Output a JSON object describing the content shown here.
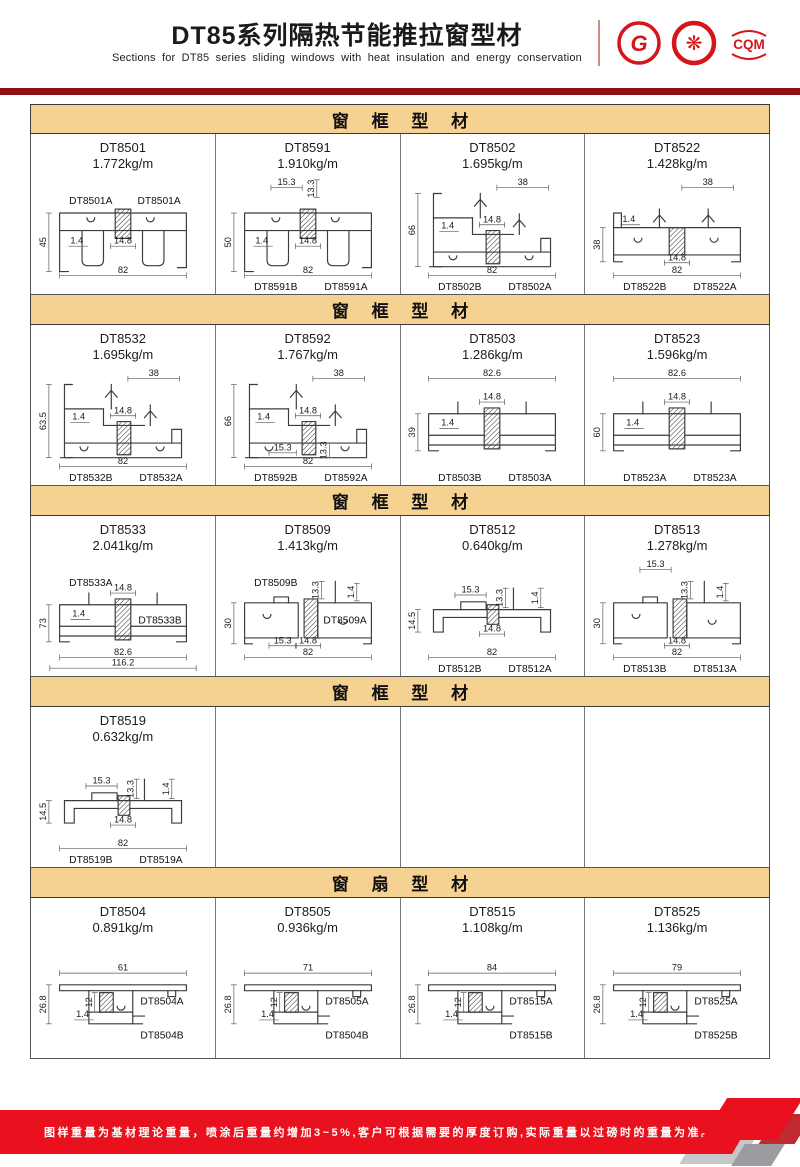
{
  "header": {
    "title": "DT85系列隔热节能推拉窗型材",
    "subtitle": "Sections for DT85 series sliding windows with heat insulation and energy conservation",
    "logos": [
      {
        "name": "jiahua-certification-logo",
        "label": "G"
      },
      {
        "name": "round-emblem-logo",
        "label": "❋"
      },
      {
        "name": "cqm-certification-logo",
        "label": "CQM"
      }
    ]
  },
  "colors": {
    "section_header_tan": "#f6d292",
    "header_rule_dark_red": "#8e1114",
    "footer_red": "#e8111d",
    "logo_red": "#d61518"
  },
  "sections": [
    {
      "title": "窗 框 型 材",
      "cells": [
        {
          "model": "DT8501",
          "weight": "1.772kg/m",
          "figure": "dc",
          "part_labels": [
            {
              "text": "DT8501A",
              "pos": "top-left"
            },
            {
              "text": "DT8501A",
              "pos": "top-right"
            }
          ],
          "dims": [
            {
              "v": "45",
              "pos": "left"
            },
            {
              "v": "1.4",
              "pos": "wall"
            },
            {
              "v": "14.8",
              "pos": "interlock"
            },
            {
              "v": "82",
              "pos": "bottom"
            }
          ]
        },
        {
          "model": "DT8591",
          "weight": "1.910kg/m",
          "figure": "dc",
          "part_labels": [
            {
              "text": "DT8591B",
              "pos": "bottom-left"
            },
            {
              "text": "DT8591A",
              "pos": "bottom-right"
            }
          ],
          "dims": [
            {
              "v": "15.3",
              "pos": "top-sm1"
            },
            {
              "v": "13.3",
              "pos": "top-sm2"
            },
            {
              "v": "50",
              "pos": "left"
            },
            {
              "v": "1.4",
              "pos": "wall"
            },
            {
              "v": "14.8",
              "pos": "interlock"
            },
            {
              "v": "82",
              "pos": "bottom"
            }
          ]
        },
        {
          "model": "DT8502",
          "weight": "1.695kg/m",
          "figure": "step",
          "part_labels": [
            {
              "text": "DT8502B",
              "pos": "bottom-left"
            },
            {
              "text": "DT8502A",
              "pos": "bottom-right"
            }
          ],
          "dims": [
            {
              "v": "38",
              "pos": "top"
            },
            {
              "v": "66",
              "pos": "left"
            },
            {
              "v": "1.4",
              "pos": "wall"
            },
            {
              "v": "14.8",
              "pos": "interlock"
            },
            {
              "v": "82",
              "pos": "bottom"
            }
          ]
        },
        {
          "model": "DT8522",
          "weight": "1.428kg/m",
          "figure": "hook",
          "part_labels": [
            {
              "text": "DT8522B",
              "pos": "bottom-left"
            },
            {
              "text": "DT8522A",
              "pos": "bottom-right"
            }
          ],
          "dims": [
            {
              "v": "38",
              "pos": "top"
            },
            {
              "v": "1.4",
              "pos": "wall"
            },
            {
              "v": "38",
              "pos": "left"
            },
            {
              "v": "14.8",
              "pos": "interlock"
            },
            {
              "v": "82",
              "pos": "bottom"
            }
          ]
        }
      ]
    },
    {
      "title": "窗 框 型 材",
      "cells": [
        {
          "model": "DT8532",
          "weight": "1.695kg/m",
          "figure": "step",
          "part_labels": [
            {
              "text": "DT8532B",
              "pos": "bottom-left"
            },
            {
              "text": "DT8532A",
              "pos": "bottom-right"
            }
          ],
          "dims": [
            {
              "v": "38",
              "pos": "top"
            },
            {
              "v": "63.5",
              "pos": "left"
            },
            {
              "v": "1.4",
              "pos": "wall"
            },
            {
              "v": "14.8",
              "pos": "interlock"
            },
            {
              "v": "82",
              "pos": "bottom"
            }
          ]
        },
        {
          "model": "DT8592",
          "weight": "1.767kg/m",
          "figure": "step",
          "part_labels": [
            {
              "text": "DT8592B",
              "pos": "bottom-left"
            },
            {
              "text": "DT8592A",
              "pos": "bottom-right"
            }
          ],
          "dims": [
            {
              "v": "38",
              "pos": "top"
            },
            {
              "v": "66",
              "pos": "left"
            },
            {
              "v": "1.4",
              "pos": "wall"
            },
            {
              "v": "14.8",
              "pos": "interlock"
            },
            {
              "v": "15.3",
              "pos": "bottom-sm"
            },
            {
              "v": "13.3",
              "pos": "bottom-sm2"
            },
            {
              "v": "82",
              "pos": "bottom"
            }
          ]
        },
        {
          "model": "DT8503",
          "weight": "1.286kg/m",
          "figure": "flat",
          "part_labels": [
            {
              "text": "DT8503B",
              "pos": "bottom-left"
            },
            {
              "text": "DT8503A",
              "pos": "bottom-right"
            }
          ],
          "dims": [
            {
              "v": "82.6",
              "pos": "top"
            },
            {
              "v": "1.4",
              "pos": "wall"
            },
            {
              "v": "14.8",
              "pos": "interlock"
            },
            {
              "v": "39",
              "pos": "left"
            }
          ]
        },
        {
          "model": "DT8523",
          "weight": "1.596kg/m",
          "figure": "flat",
          "part_labels": [
            {
              "text": "DT8523A",
              "pos": "bottom-left"
            },
            {
              "text": "DT8523A",
              "pos": "bottom-right"
            }
          ],
          "dims": [
            {
              "v": "82.6",
              "pos": "top"
            },
            {
              "v": "1.4",
              "pos": "wall"
            },
            {
              "v": "60",
              "pos": "left"
            },
            {
              "v": "14.8",
              "pos": "interlock"
            }
          ]
        }
      ]
    },
    {
      "title": "窗 框 型 材",
      "cells": [
        {
          "model": "DT8533",
          "weight": "2.041kg/m",
          "figure": "flat",
          "part_labels": [
            {
              "text": "DT8533A",
              "pos": "top-left"
            },
            {
              "text": "DT8533B",
              "pos": "mid-right"
            }
          ],
          "dims": [
            {
              "v": "73",
              "pos": "left"
            },
            {
              "v": "1.4",
              "pos": "wall"
            },
            {
              "v": "14.8",
              "pos": "interlock"
            },
            {
              "v": "82.6",
              "pos": "bottom"
            },
            {
              "v": "116.2",
              "pos": "bottom2"
            }
          ]
        },
        {
          "model": "DT8509",
          "weight": "1.413kg/m",
          "figure": "mid",
          "part_labels": [
            {
              "text": "DT8509B",
              "pos": "top-left"
            },
            {
              "text": "DT8509A",
              "pos": "mid-right"
            }
          ],
          "dims": [
            {
              "v": "13.3",
              "pos": "top-sm2"
            },
            {
              "v": "1.4",
              "pos": "right-sm"
            },
            {
              "v": "30",
              "pos": "left"
            },
            {
              "v": "15.3",
              "pos": "bottom-sm"
            },
            {
              "v": "14.8",
              "pos": "interlock"
            },
            {
              "v": "82",
              "pos": "bottom"
            }
          ]
        },
        {
          "model": "DT8512",
          "weight": "0.640kg/m",
          "figure": "thin",
          "part_labels": [
            {
              "text": "DT8512B",
              "pos": "bottom-left"
            },
            {
              "text": "DT8512A",
              "pos": "bottom-right"
            }
          ],
          "dims": [
            {
              "v": "15.3",
              "pos": "top-sm1"
            },
            {
              "v": "13.3",
              "pos": "top-sm2"
            },
            {
              "v": "1.4",
              "pos": "right-sm"
            },
            {
              "v": "14.5",
              "pos": "left"
            },
            {
              "v": "14.8",
              "pos": "interlock"
            },
            {
              "v": "82",
              "pos": "bottom"
            }
          ]
        },
        {
          "model": "DT8513",
          "weight": "1.278kg/m",
          "figure": "mid",
          "part_labels": [
            {
              "text": "DT8513B",
              "pos": "bottom-left"
            },
            {
              "text": "DT8513A",
              "pos": "bottom-right"
            }
          ],
          "dims": [
            {
              "v": "15.3",
              "pos": "top-sm1"
            },
            {
              "v": "13.3",
              "pos": "top-sm2"
            },
            {
              "v": "1.4",
              "pos": "right-sm"
            },
            {
              "v": "30",
              "pos": "left"
            },
            {
              "v": "14.8",
              "pos": "interlock"
            },
            {
              "v": "82",
              "pos": "bottom"
            }
          ]
        }
      ]
    },
    {
      "title": "窗 框 型 材",
      "cells": [
        {
          "model": "DT8519",
          "weight": "0.632kg/m",
          "figure": "thin",
          "part_labels": [
            {
              "text": "DT8519B",
              "pos": "bottom-left"
            },
            {
              "text": "DT8519A",
              "pos": "bottom-right"
            }
          ],
          "dims": [
            {
              "v": "15.3",
              "pos": "top-sm1"
            },
            {
              "v": "13.3",
              "pos": "top-sm2"
            },
            {
              "v": "1.4",
              "pos": "right-sm"
            },
            {
              "v": "14.5",
              "pos": "left"
            },
            {
              "v": "14.8",
              "pos": "interlock"
            },
            {
              "v": "82",
              "pos": "bottom"
            }
          ]
        },
        null,
        null,
        null
      ]
    },
    {
      "title": "窗 扇 型 材",
      "cells": [
        {
          "model": "DT8504",
          "weight": "0.891kg/m",
          "figure": "sash",
          "part_labels": [
            {
              "text": "DT8504A",
              "pos": "right-mid"
            },
            {
              "text": "DT8504B",
              "pos": "right-low"
            }
          ],
          "dims": [
            {
              "v": "61",
              "pos": "top"
            },
            {
              "v": "26.8",
              "pos": "left"
            },
            {
              "v": "12",
              "pos": "inner-v"
            },
            {
              "v": "1.4",
              "pos": "wall"
            }
          ]
        },
        {
          "model": "DT8505",
          "weight": "0.936kg/m",
          "figure": "sash",
          "part_labels": [
            {
              "text": "DT8505A",
              "pos": "right-mid"
            },
            {
              "text": "DT8504B",
              "pos": "right-low"
            }
          ],
          "dims": [
            {
              "v": "71",
              "pos": "top"
            },
            {
              "v": "26.8",
              "pos": "left"
            },
            {
              "v": "12",
              "pos": "inner-v"
            },
            {
              "v": "1.4",
              "pos": "wall"
            }
          ]
        },
        {
          "model": "DT8515",
          "weight": "1.108kg/m",
          "figure": "sash",
          "part_labels": [
            {
              "text": "DT8515A",
              "pos": "right-mid"
            },
            {
              "text": "DT8515B",
              "pos": "right-low"
            }
          ],
          "dims": [
            {
              "v": "84",
              "pos": "top"
            },
            {
              "v": "26.8",
              "pos": "left"
            },
            {
              "v": "12",
              "pos": "inner-v"
            },
            {
              "v": "1.4",
              "pos": "wall"
            }
          ]
        },
        {
          "model": "DT8525",
          "weight": "1.136kg/m",
          "figure": "sash",
          "part_labels": [
            {
              "text": "DT8525A",
              "pos": "right-mid"
            },
            {
              "text": "DT8525B",
              "pos": "right-low"
            }
          ],
          "dims": [
            {
              "v": "79",
              "pos": "top"
            },
            {
              "v": "26.8",
              "pos": "left"
            },
            {
              "v": "12",
              "pos": "inner-v"
            },
            {
              "v": "1.4",
              "pos": "wall"
            }
          ]
        }
      ]
    }
  ],
  "footer": {
    "note": "图样重量为基材理论重量，喷涂后重量约增加3~5%,客户可根据需要的厚度订购,实际重量以过磅时的重量为准。",
    "brand_line1": "JIAHUA",
    "brand_line2": "ALUMINIUM",
    "page_number": "155"
  }
}
